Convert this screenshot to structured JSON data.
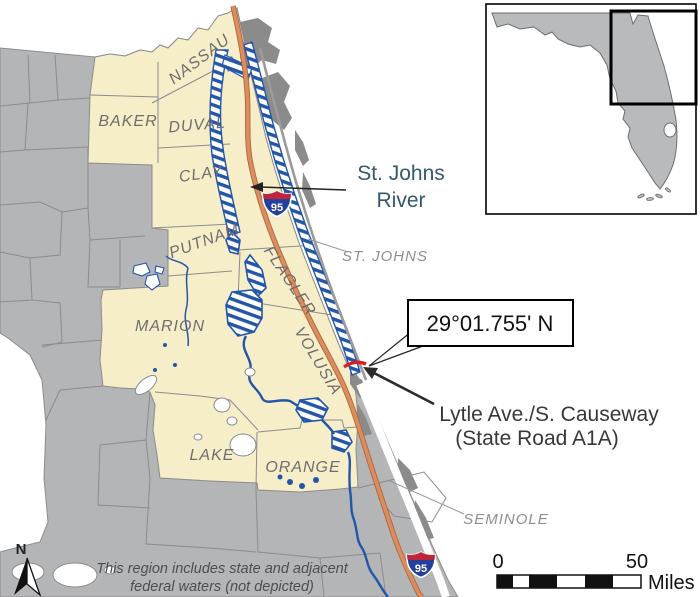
{
  "map": {
    "county_labels": {
      "nassau": "NASSAU",
      "duval": "DUVAL",
      "baker": "BAKER",
      "clay": "CLAY",
      "putnam": "PUTNAM",
      "flagler": "FLAGLER",
      "marion": "MARION",
      "volusia": "VOLUSIA",
      "lake": "LAKE",
      "orange": "ORANGE"
    },
    "neighbor_labels": {
      "st_johns": "ST. JOHNS",
      "seminole": "SEMINOLE"
    },
    "river_label": {
      "line1": "St. Johns",
      "line2": "River"
    },
    "latitude_callout": "29°01.755' N",
    "causeway_label": {
      "line1": "Lytle Ave./S. Causeway",
      "line2": "(State Road A1A)"
    },
    "note": {
      "line1": "This region includes state and adjacent",
      "line2": "federal waters (not depicted)"
    },
    "highway_shield": "95",
    "compass_north": "N",
    "scale_bar": {
      "start": "0",
      "end": "50",
      "unit": "Miles"
    },
    "colors": {
      "highlight_region": "#F6EDC9",
      "land_gray": "#B4B5B7",
      "water_blue": "#2456A8",
      "interstate_orange": "#D78E60",
      "site_marker_red": "#D81E1E"
    }
  }
}
